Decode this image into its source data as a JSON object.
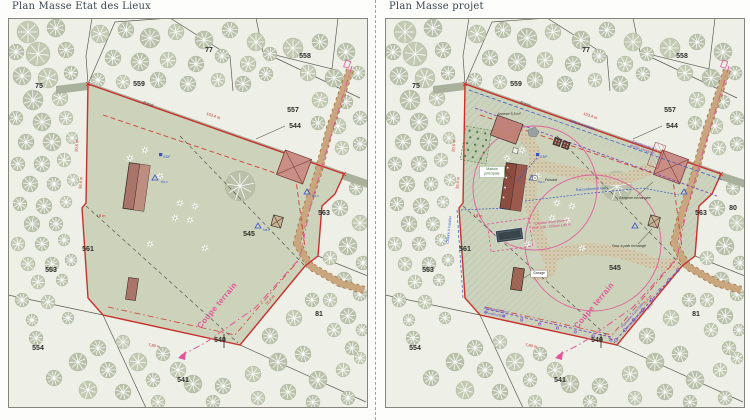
{
  "sheet": {
    "background": "#fdfdfb"
  },
  "colors": {
    "boundary_red": "#c9302c",
    "section_pink": "#e0559a",
    "utility_blue": "#3554c4",
    "hedge_purple": "#7b49bd",
    "parcel_fill": "#cdd3bb",
    "woods_fill": "#eef0e8",
    "tree_fill": "#b9c1ab",
    "path_tan": "#c9a67e",
    "building_red": "#a9756b",
    "pool_dark": "#39444b"
  },
  "panels": [
    {
      "title": "Plan Masse Etat des Lieux",
      "labels": [
        {
          "t": "75",
          "x": 31,
          "y": 70,
          "c": "pnum"
        },
        {
          "t": "77",
          "x": 201,
          "y": 34,
          "c": "pnum"
        },
        {
          "t": "558",
          "x": 297,
          "y": 40,
          "c": "pnum"
        },
        {
          "t": "559",
          "x": 131,
          "y": 68,
          "c": "pnum"
        },
        {
          "t": "557",
          "x": 285,
          "y": 94,
          "c": "pnum"
        },
        {
          "t": "544",
          "x": 287,
          "y": 110,
          "c": "pnum"
        },
        {
          "t": "563",
          "x": 316,
          "y": 197,
          "c": "pnum"
        },
        {
          "t": "561",
          "x": 80,
          "y": 233,
          "c": "pnum"
        },
        {
          "t": "545",
          "x": 241,
          "y": 218,
          "c": "pnum"
        },
        {
          "t": "553",
          "x": 43,
          "y": 254,
          "c": "pnum"
        },
        {
          "t": "554",
          "x": 30,
          "y": 332,
          "c": "pnum"
        },
        {
          "t": "541",
          "x": 175,
          "y": 364,
          "c": "pnum"
        },
        {
          "t": "540",
          "x": 212,
          "y": 324,
          "c": "pnum"
        },
        {
          "t": "81",
          "x": 311,
          "y": 298,
          "c": "pnum"
        },
        {
          "t": "Fossé",
          "x": 140,
          "y": 87,
          "r": 19,
          "c": "fosse"
        },
        {
          "t": "103,4 m",
          "x": 205,
          "y": 99,
          "r": 19,
          "c": "dim"
        },
        {
          "t": "20,6 m",
          "x": 70,
          "y": 128,
          "r": -84,
          "c": "dim"
        },
        {
          "t": "39,6 m",
          "x": 74,
          "y": 165,
          "r": -84,
          "c": "dim"
        },
        {
          "t": "18 m",
          "x": 93,
          "y": 199,
          "r": 4,
          "c": "dim"
        },
        {
          "t": "75,4 m",
          "x": 263,
          "y": 283,
          "r": -49,
          "c": "dim"
        },
        {
          "t": "7,80 m",
          "x": 146,
          "y": 329,
          "r": 11,
          "c": "dim"
        },
        {
          "t": "EDF",
          "x": 159,
          "y": 140,
          "c": "blue"
        },
        {
          "t": "752,4",
          "x": 156,
          "y": 165,
          "c": "alt"
        },
        {
          "t": "749,6",
          "x": 307,
          "y": 179,
          "c": "alt"
        },
        {
          "t": "748,2",
          "x": 258,
          "y": 213,
          "c": "alt"
        },
        {
          "t": "Coupe terrain",
          "x": 211,
          "y": 289,
          "r": -50,
          "c": "coupe"
        }
      ]
    },
    {
      "title": "Plan Masse projet",
      "labels": [
        {
          "t": "75",
          "x": 31,
          "y": 70,
          "c": "pnum"
        },
        {
          "t": "77",
          "x": 201,
          "y": 34,
          "c": "pnum"
        },
        {
          "t": "558",
          "x": 297,
          "y": 40,
          "c": "pnum"
        },
        {
          "t": "559",
          "x": 131,
          "y": 68,
          "c": "pnum"
        },
        {
          "t": "557",
          "x": 285,
          "y": 94,
          "c": "pnum"
        },
        {
          "t": "544",
          "x": 287,
          "y": 110,
          "c": "pnum"
        },
        {
          "t": "563",
          "x": 316,
          "y": 197,
          "c": "pnum"
        },
        {
          "t": "561",
          "x": 80,
          "y": 233,
          "c": "pnum"
        },
        {
          "t": "545",
          "x": 230,
          "y": 252,
          "c": "pnum"
        },
        {
          "t": "553",
          "x": 43,
          "y": 254,
          "c": "pnum"
        },
        {
          "t": "554",
          "x": 30,
          "y": 332,
          "c": "pnum"
        },
        {
          "t": "541",
          "x": 175,
          "y": 364,
          "c": "pnum"
        },
        {
          "t": "540",
          "x": 212,
          "y": 324,
          "c": "pnum"
        },
        {
          "t": "81",
          "x": 311,
          "y": 298,
          "c": "pnum"
        },
        {
          "t": "80",
          "x": 348,
          "y": 192,
          "c": "pnum"
        },
        {
          "t": "Fossé",
          "x": 140,
          "y": 87,
          "r": 19,
          "c": "fosse"
        },
        {
          "t": "103,4 m",
          "x": 205,
          "y": 99,
          "r": 19,
          "c": "dim"
        },
        {
          "t": "20,6 m",
          "x": 70,
          "y": 128,
          "r": -84,
          "c": "dim"
        },
        {
          "t": "39,6 m",
          "x": 74,
          "y": 165,
          "r": -84,
          "c": "dim"
        },
        {
          "t": "18 m",
          "x": 93,
          "y": 199,
          "r": 4,
          "c": "dim"
        },
        {
          "t": "75,4 m",
          "x": 263,
          "y": 283,
          "r": -49,
          "c": "dim"
        },
        {
          "t": "7,80 m",
          "x": 146,
          "y": 329,
          "r": 11,
          "c": "dim"
        },
        {
          "t": "EDF",
          "x": 159,
          "y": 140,
          "c": "blue"
        },
        {
          "t": "752,4",
          "x": 156,
          "y": 165,
          "c": "alt"
        },
        {
          "t": "Coupe terrain",
          "x": 211,
          "y": 289,
          "r": -50,
          "c": "coupe"
        },
        {
          "t": "Clôture existante",
          "x": 197,
          "y": 108,
          "r": 19,
          "c": "blue"
        },
        {
          "t": "Raccordement eau",
          "x": 206,
          "y": 172,
          "r": -4,
          "c": "blue"
        },
        {
          "t": "Clôture à installer",
          "x": 65,
          "y": 212,
          "r": -84,
          "c": "blue"
        },
        {
          "t": "Bande de 15 m\ninconstructible",
          "x": 110,
          "y": 293,
          "r": 11,
          "c": "bande"
        },
        {
          "t": "15 m",
          "x": 266,
          "y": 289,
          "r": -49,
          "c": "blue"
        },
        {
          "t": "Extension de la\ngrange existante",
          "x": 258,
          "y": 128,
          "r": 19,
          "c": "purple"
        },
        {
          "t": "Plantation d'une haie\nd'essences locales",
          "x": 248,
          "y": 298,
          "r": -49,
          "c": "purple"
        },
        {
          "t": "Bergerie inchangée",
          "x": 250,
          "y": 181,
          "c": "lbl"
        },
        {
          "t": "Four à pain inchangé",
          "x": 244,
          "y": 229,
          "c": "lbl"
        },
        {
          "t": "Annexe 5,5 m²",
          "x": 124,
          "y": 97,
          "c": "lbl"
        },
        {
          "t": "Garage",
          "x": 154,
          "y": 256,
          "c": "boxed"
        },
        {
          "t": "Maison\nprincipale",
          "x": 107,
          "y": 152,
          "c": "boxedg"
        },
        {
          "t": "Puisard",
          "x": 166,
          "y": 163,
          "c": "lbl"
        },
        {
          "t": "Création d'une piscine\nProf. 1,50 - Clôture 1,80 m",
          "x": 166,
          "y": 205,
          "r": -6,
          "c": "pinks"
        }
      ]
    }
  ]
}
